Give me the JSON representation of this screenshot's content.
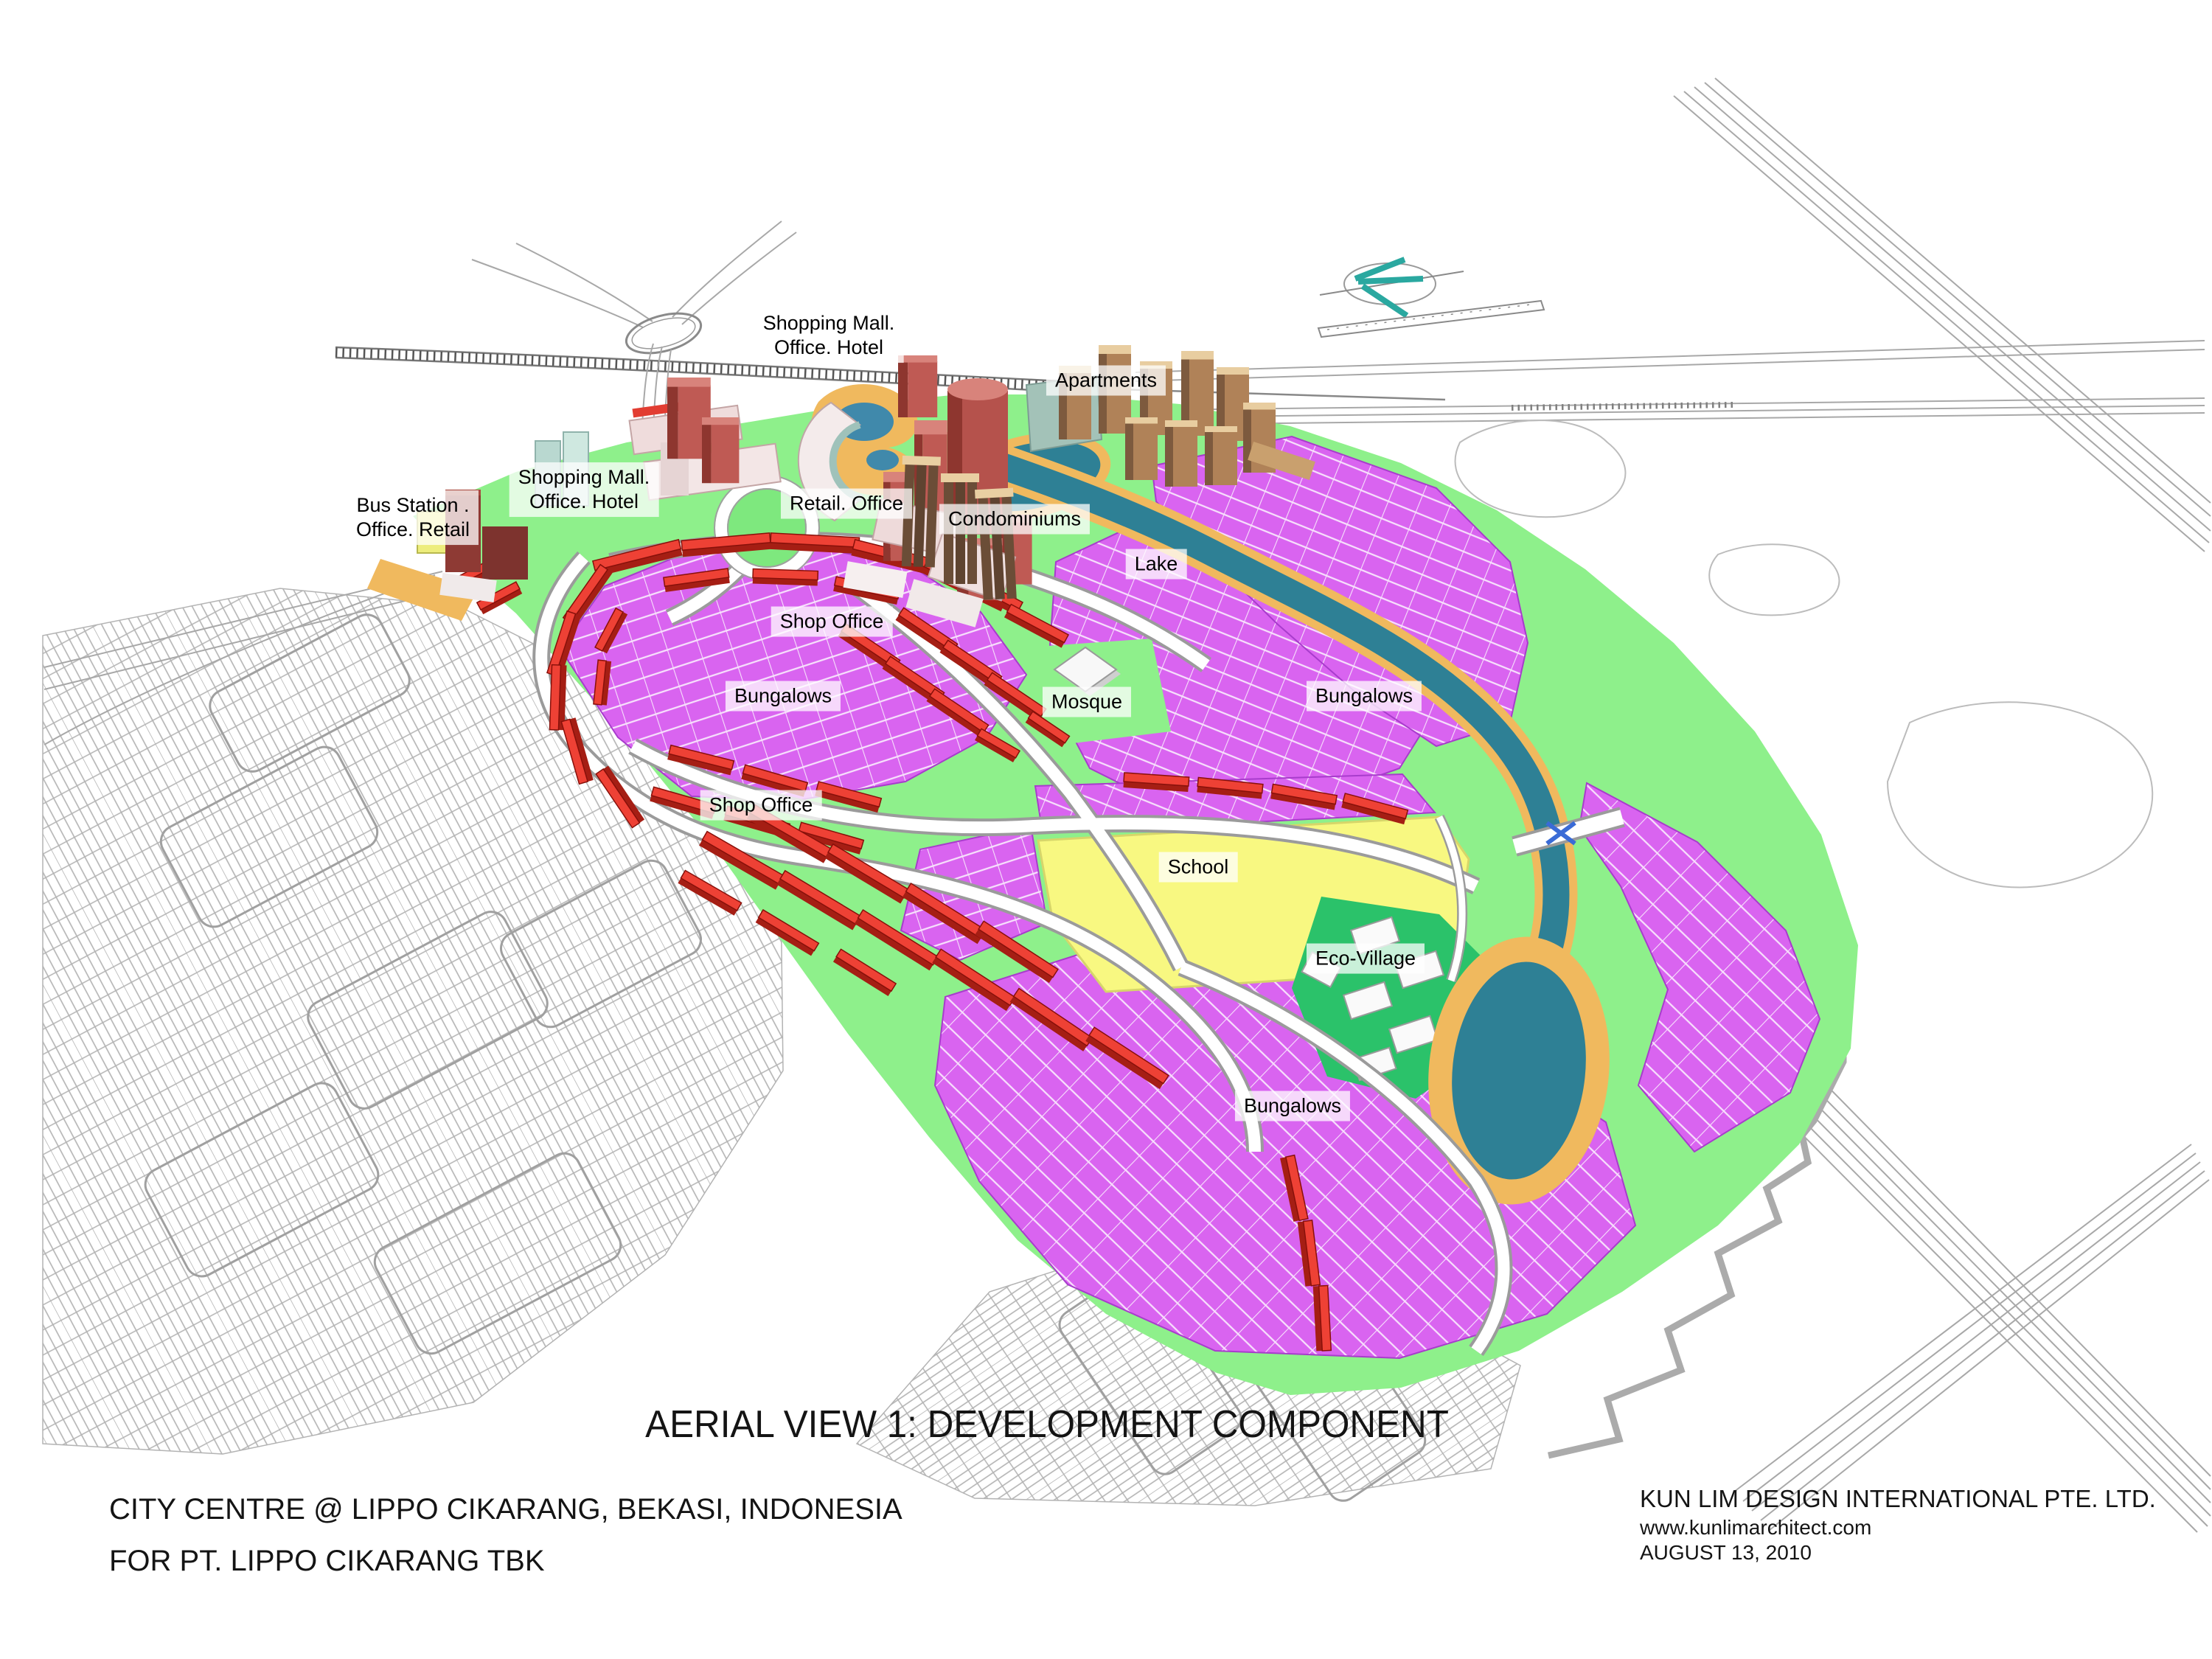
{
  "title": "AERIAL VIEW 1: DEVELOPMENT COMPONENT",
  "labels": {
    "shopping_mall_north": {
      "line1": "Shopping Mall.",
      "line2": "Office. Hotel"
    },
    "apartments": "Apartments",
    "shopping_mall_west": {
      "line1": "Shopping Mall.",
      "line2": "Office. Hotel"
    },
    "bus_station": {
      "line1": "Bus Station .",
      "line2": "Office. Retail"
    },
    "retail_office": "Retail. Office",
    "condominiums": "Condominiums",
    "lake": "Lake",
    "shop_office_north": "Shop Office",
    "bungalows_west": "Bungalows",
    "mosque": "Mosque",
    "bungalows_east": "Bungalows",
    "shop_office_south": "Shop Office",
    "school": "School",
    "eco_village": "Eco-Village",
    "bungalows_south": "Bungalows"
  },
  "credits": {
    "project_line1": "CITY CENTRE @ LIPPO CIKARANG, BEKASI, INDONESIA",
    "project_line2": "FOR PT. LIPPO CIKARANG TBK",
    "firm": "KUN LIM DESIGN INTERNATIONAL PTE. LTD.",
    "website": "www.kunlimarchitect.com",
    "date": "AUGUST 13, 2010"
  },
  "colors": {
    "bungalow_magenta": "#d964f0",
    "shop_office_red": "#ee4135",
    "school_yellow": "#f8f881",
    "eco_village_green": "#2bc26a",
    "lake_teal": "#2e8095",
    "lakeside_road_orange": "#f0b95e",
    "landscape_green": "#8ef08b",
    "tower_red": "#b5524c",
    "apartment_tan": "#b08258",
    "condominium_brown": "#6b4d37",
    "linework_gray": "#a0a0a0",
    "label_background": "#ffffff"
  }
}
